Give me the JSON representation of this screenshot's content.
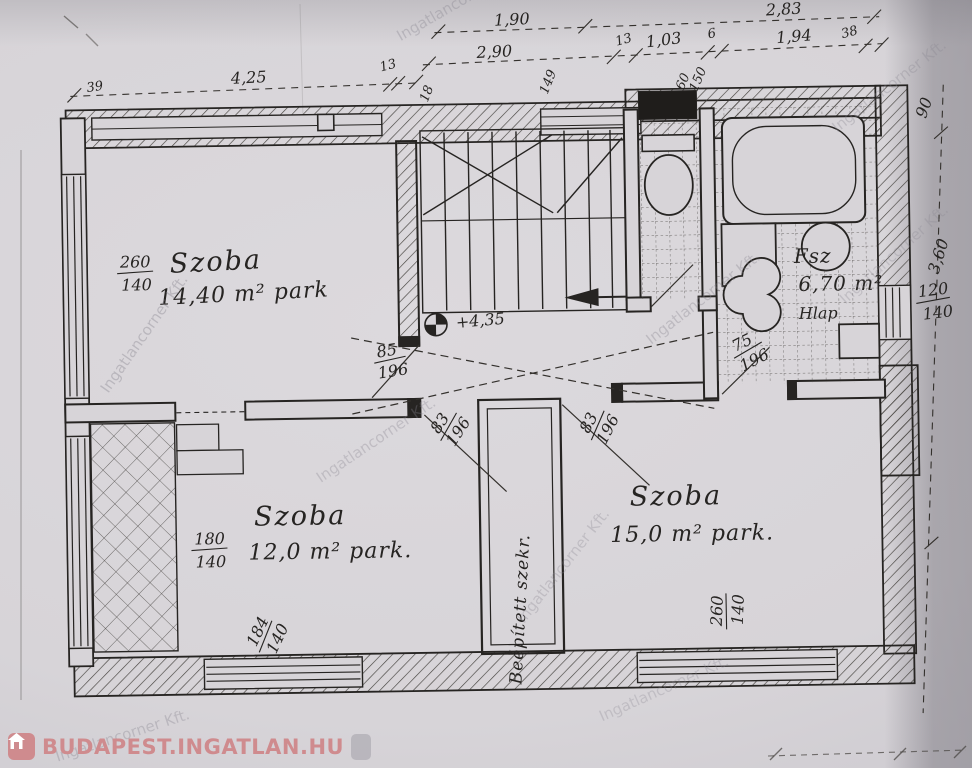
{
  "colors": {
    "paper": "#d7d4d8",
    "ink": "#262422",
    "logo": "#cf8b8e",
    "watermark": "#87848f"
  },
  "rooms": {
    "top_left": {
      "name": "Szoba",
      "area": "14,40 m² park"
    },
    "bottom_left": {
      "name": "Szoba",
      "area": "12,0 m² park."
    },
    "bottom_right": {
      "name": "Szoba",
      "area": "15,0 m² park."
    },
    "bathroom": {
      "name": "Fsz",
      "area": "6,70 m²",
      "floor": "Hlap"
    },
    "closet": {
      "name": "Beépített szekr."
    }
  },
  "level_mark": "+4,35",
  "dims": {
    "top_row1": [
      "1,90",
      "2,83"
    ],
    "top_row2": [
      "2,90",
      "13",
      "1,03",
      "6",
      "1,94",
      "38"
    ],
    "upper_left": [
      "4,25",
      "13"
    ],
    "left": [
      "39"
    ],
    "right": [
      "90",
      "3,60"
    ],
    "small_top": [
      "18",
      "149"
    ],
    "windows": {
      "top_left": {
        "num": "260",
        "den": "140"
      },
      "mid_left": {
        "num": "180",
        "den": "140"
      },
      "bottom_left": {
        "num": "184",
        "den": "140"
      },
      "bottom_right": {
        "num": "260",
        "den": "140"
      },
      "right": {
        "num": "120",
        "den": "140"
      },
      "small_top": {
        "num": "60",
        "den": "150"
      }
    },
    "doors": {
      "hall": {
        "num": "85",
        "den": "196"
      },
      "room_left": {
        "num": "83",
        "den": "196"
      },
      "room_right": {
        "num": "83",
        "den": "196"
      },
      "bathroom": {
        "num": "75",
        "den": "196"
      }
    }
  },
  "watermark": {
    "text": "Ingatlancorner Kft."
  },
  "footer": {
    "logo_text": "BUDAPEST.INGATLAN.HU"
  }
}
